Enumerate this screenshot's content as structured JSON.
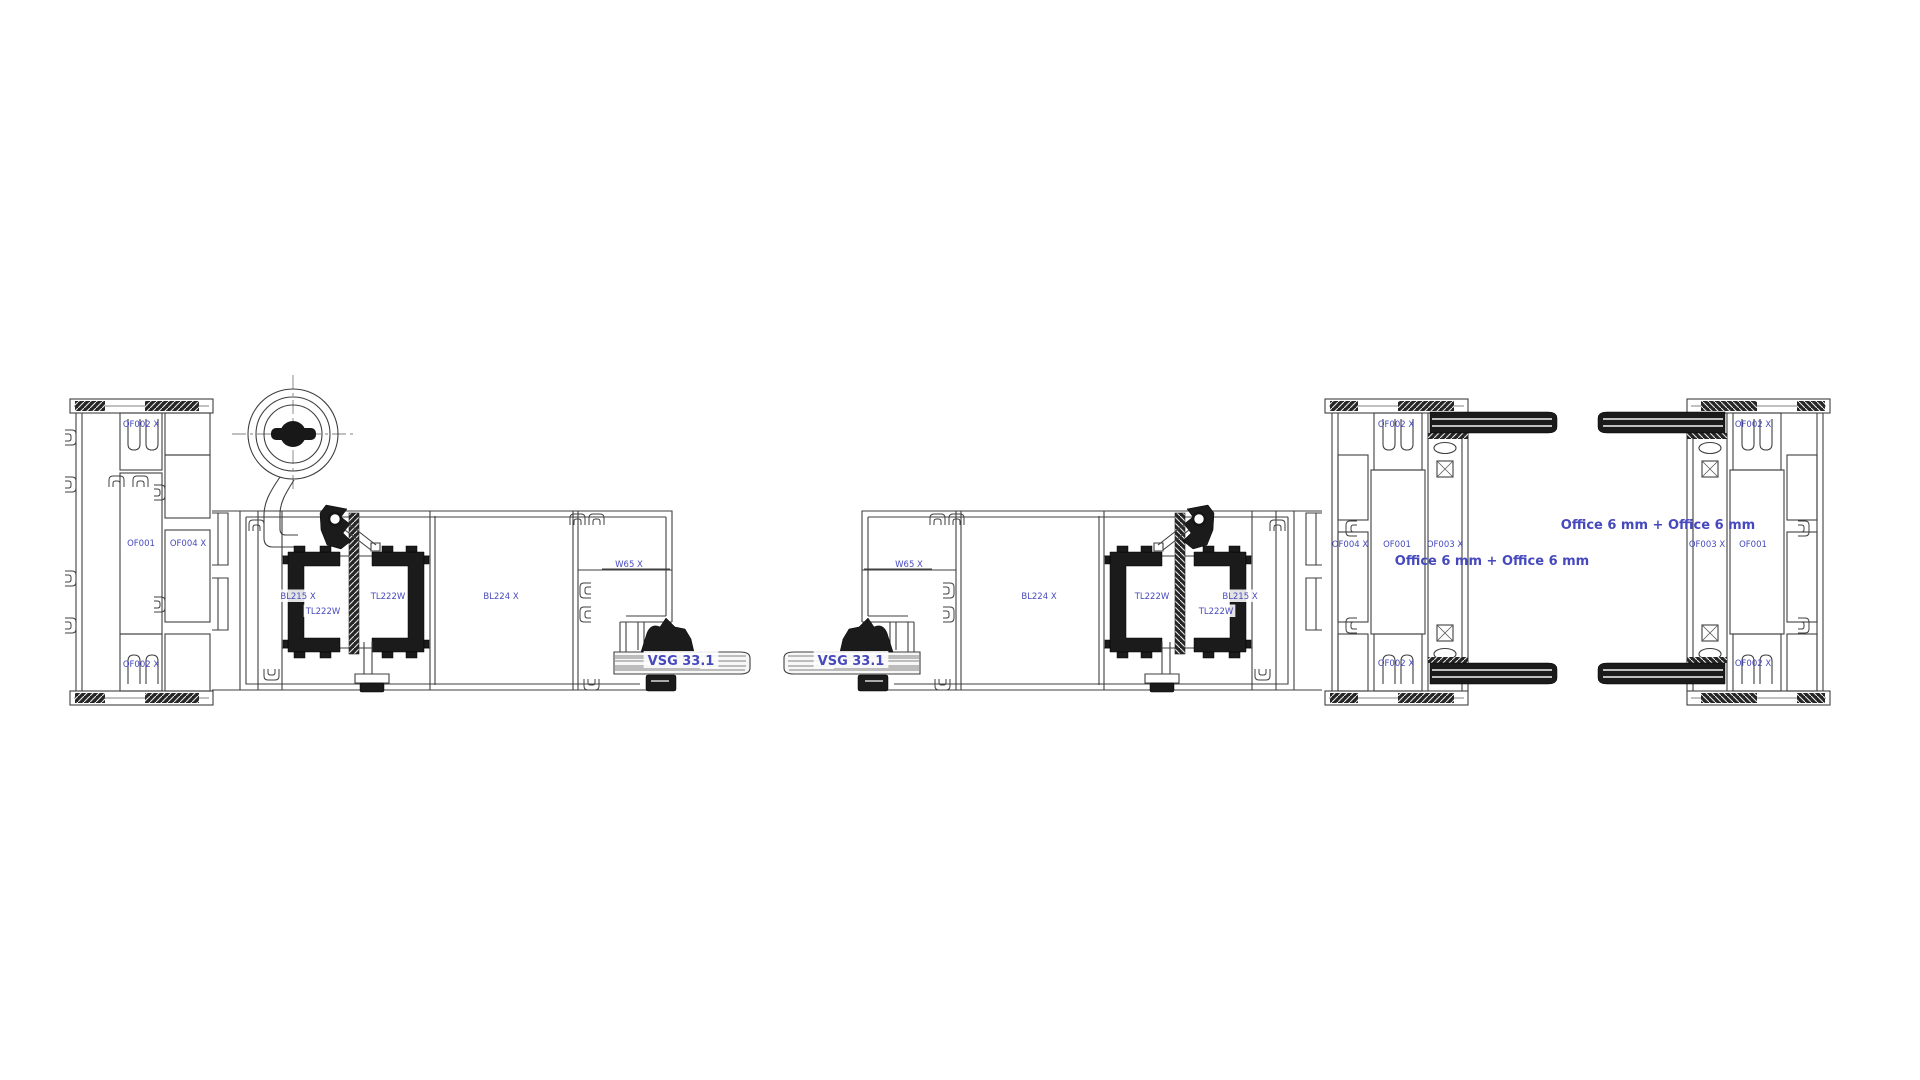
{
  "drawing": {
    "type": "technical-cross-section",
    "description": "Aluminium sliding door system - horizontal section details",
    "colors": {
      "background": "#ffffff",
      "line": "#3f3f3f",
      "dark_profile_fill": "#1b1b1b",
      "label_blue": "#4649bd",
      "glass_fill": "#f7f7f7"
    },
    "labels": [
      {
        "name": "label-of002x-jamb-top",
        "group": "left-jamb",
        "text": "OF002 X",
        "x": 141,
        "y": 427,
        "size": 8.5,
        "weight": 400,
        "bg": false
      },
      {
        "name": "label-of001-jamb",
        "group": "left-jamb",
        "text": "OF001",
        "x": 141,
        "y": 546,
        "size": 8.5,
        "weight": 400,
        "bg": false
      },
      {
        "name": "label-of004x-jamb",
        "group": "left-jamb",
        "text": "OF004 X",
        "x": 188,
        "y": 546,
        "size": 8.5,
        "weight": 400,
        "bg": false
      },
      {
        "name": "label-of002x-jamb-bottom",
        "group": "left-jamb",
        "text": "OF002 X",
        "x": 141,
        "y": 667,
        "size": 8.5,
        "weight": 400,
        "bg": false
      },
      {
        "name": "label-bl215x-left",
        "group": "left-panel",
        "text": "BL215 X",
        "x": 298,
        "y": 599,
        "size": 8.5,
        "weight": 400,
        "bg": true
      },
      {
        "name": "label-tl222w-left-lower",
        "group": "left-panel",
        "text": "TL222W",
        "x": 323,
        "y": 614,
        "size": 8.5,
        "weight": 400,
        "bg": true
      },
      {
        "name": "label-tl222w-left-upper",
        "group": "left-panel",
        "text": "TL222W",
        "x": 388,
        "y": 599,
        "size": 8.5,
        "weight": 400,
        "bg": true
      },
      {
        "name": "label-bl224x-left",
        "group": "left-panel",
        "text": "BL224 X",
        "x": 501,
        "y": 599,
        "size": 8.5,
        "weight": 400,
        "bg": false
      },
      {
        "name": "label-w65x-left",
        "group": "left-panel",
        "text": "W65 X",
        "x": 629,
        "y": 567,
        "size": 8.5,
        "weight": 400,
        "bg": false
      },
      {
        "name": "label-vsg331-left",
        "group": "left-panel",
        "text": "VSG 33.1",
        "x": 681,
        "y": 665,
        "size": 13,
        "weight": 700,
        "bg": true
      },
      {
        "name": "label-vsg331-right",
        "group": "right-panel",
        "text": "VSG 33.1",
        "x": 851,
        "y": 665,
        "size": 13,
        "weight": 700,
        "bg": true
      },
      {
        "name": "label-w65x-right",
        "group": "right-panel",
        "text": "W65 X",
        "x": 909,
        "y": 567,
        "size": 8.5,
        "weight": 400,
        "bg": false
      },
      {
        "name": "label-bl224x-right",
        "group": "right-panel",
        "text": "BL224 X",
        "x": 1039,
        "y": 599,
        "size": 8.5,
        "weight": 400,
        "bg": false
      },
      {
        "name": "label-tl222w-right-upper",
        "group": "right-panel",
        "text": "TL222W",
        "x": 1152,
        "y": 599,
        "size": 8.5,
        "weight": 400,
        "bg": true
      },
      {
        "name": "label-tl222w-right-lower",
        "group": "right-panel",
        "text": "TL222W",
        "x": 1216,
        "y": 614,
        "size": 8.5,
        "weight": 400,
        "bg": true
      },
      {
        "name": "label-bl215x-right",
        "group": "right-panel",
        "text": "BL215 X",
        "x": 1240,
        "y": 599,
        "size": 8.5,
        "weight": 400,
        "bg": true
      },
      {
        "name": "label-of002x-frame1-top",
        "group": "fixed-frame-1",
        "text": "OF002 X",
        "x": 1396,
        "y": 427,
        "size": 8.5,
        "weight": 400,
        "bg": false
      },
      {
        "name": "label-of004x-frame1",
        "group": "fixed-frame-1",
        "text": "OF004 X",
        "x": 1350,
        "y": 547,
        "size": 8.5,
        "weight": 400,
        "bg": false
      },
      {
        "name": "label-of001-frame1",
        "group": "fixed-frame-1",
        "text": "OF001",
        "x": 1397,
        "y": 547,
        "size": 8.5,
        "weight": 400,
        "bg": false
      },
      {
        "name": "label-of003x-frame1",
        "group": "fixed-frame-1",
        "text": "OF003 X",
        "x": 1445,
        "y": 547,
        "size": 8.5,
        "weight": 400,
        "bg": false
      },
      {
        "name": "label-of002x-frame1-bottom",
        "group": "fixed-frame-1",
        "text": "OF002 X",
        "x": 1396,
        "y": 666,
        "size": 8.5,
        "weight": 400,
        "bg": false
      },
      {
        "name": "label-glazing-office-1",
        "group": "glazing",
        "text": "Office 6 mm + Office 6 mm",
        "x": 1492,
        "y": 565,
        "size": 13,
        "weight": 700,
        "bg": false
      },
      {
        "name": "label-glazing-office-2",
        "group": "glazing",
        "text": "Office 6 mm + Office 6 mm",
        "x": 1658,
        "y": 529,
        "size": 13,
        "weight": 700,
        "bg": false
      },
      {
        "name": "label-of002x-frame2-top",
        "group": "fixed-frame-2",
        "text": "OF002 X",
        "x": 1753,
        "y": 427,
        "size": 8.5,
        "weight": 400,
        "bg": false
      },
      {
        "name": "label-of003x-frame2",
        "group": "fixed-frame-2",
        "text": "OF003 X",
        "x": 1707,
        "y": 547,
        "size": 8.5,
        "weight": 400,
        "bg": false
      },
      {
        "name": "label-of001-frame2",
        "group": "fixed-frame-2",
        "text": "OF001",
        "x": 1753,
        "y": 547,
        "size": 8.5,
        "weight": 400,
        "bg": false
      },
      {
        "name": "label-of002x-frame2-bottom",
        "group": "fixed-frame-2",
        "text": "OF002 X",
        "x": 1753,
        "y": 666,
        "size": 8.5,
        "weight": 400,
        "bg": false
      }
    ]
  }
}
